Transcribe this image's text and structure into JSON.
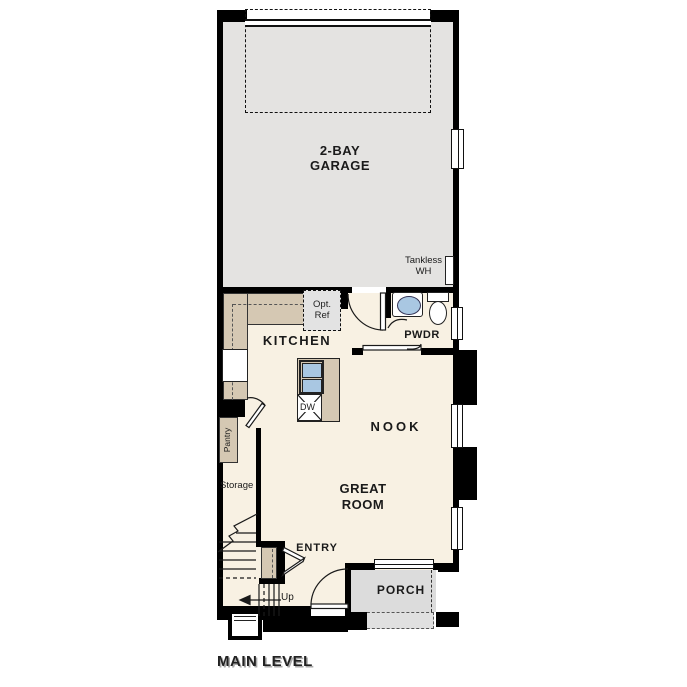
{
  "plan_title": "MAIN LEVEL",
  "rooms": {
    "garage": {
      "line1": "2-BAY",
      "line2": "GARAGE"
    },
    "kitchen": "KITCHEN",
    "nook": "NOOK",
    "great_room": {
      "line1": "GREAT",
      "line2": "ROOM"
    },
    "powder": "PWDR",
    "entry": "ENTRY",
    "porch": "PORCH"
  },
  "labels": {
    "tankless_wh": {
      "line1": "Tankless",
      "line2": "WH"
    },
    "opt_ref": {
      "line1": "Opt.",
      "line2": "Ref"
    },
    "pantry": "Pantry",
    "storage": "Storage",
    "dishwasher": "DW",
    "stairs_up": "Up"
  },
  "colors": {
    "wall": "#000000",
    "garage_floor": "#e4e3e1",
    "main_floor": "#f8f1e3",
    "cabinet_tan": "#d5c8b3",
    "porch_gray": "#dcdcdc",
    "fixture_blue": "#a9c7e2",
    "opt_ref_fill": "#e3e3e3"
  }
}
